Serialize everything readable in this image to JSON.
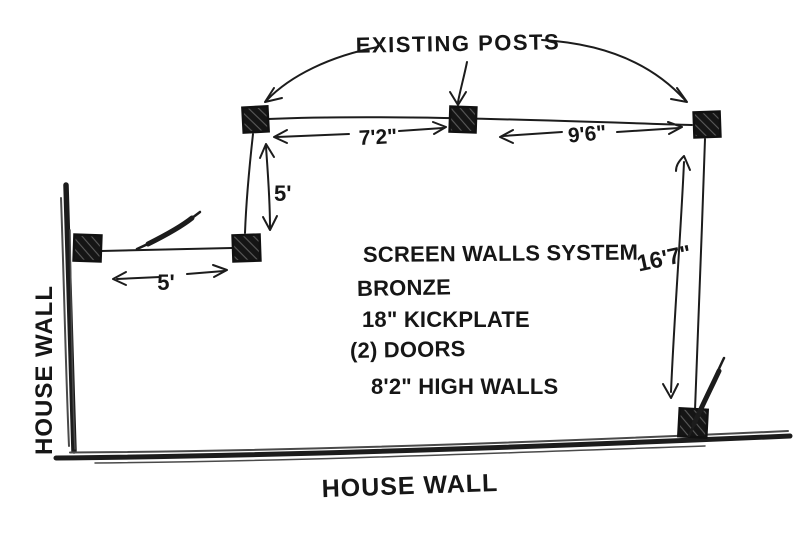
{
  "page": {
    "background": "#ffffff",
    "ink": "#1c1c1c"
  },
  "annotation": {
    "existing_posts": "EXISTING POSTS"
  },
  "dimensions": {
    "top_span_left": "7'2\"",
    "top_span_right": "9'6\"",
    "left_vertical": "5'",
    "left_horizontal": "5'",
    "right_vertical": "16'7\""
  },
  "notes": {
    "line1": "SCREEN WALLS SYSTEM",
    "line2": "BRONZE",
    "line3": "18\" KICKPLATE",
    "line4": "(2) DOORS",
    "line5": "8'2\" HIGH WALLS"
  },
  "walls": {
    "left_label": "HOUSE WALL",
    "bottom_label": "HOUSE WALL"
  }
}
